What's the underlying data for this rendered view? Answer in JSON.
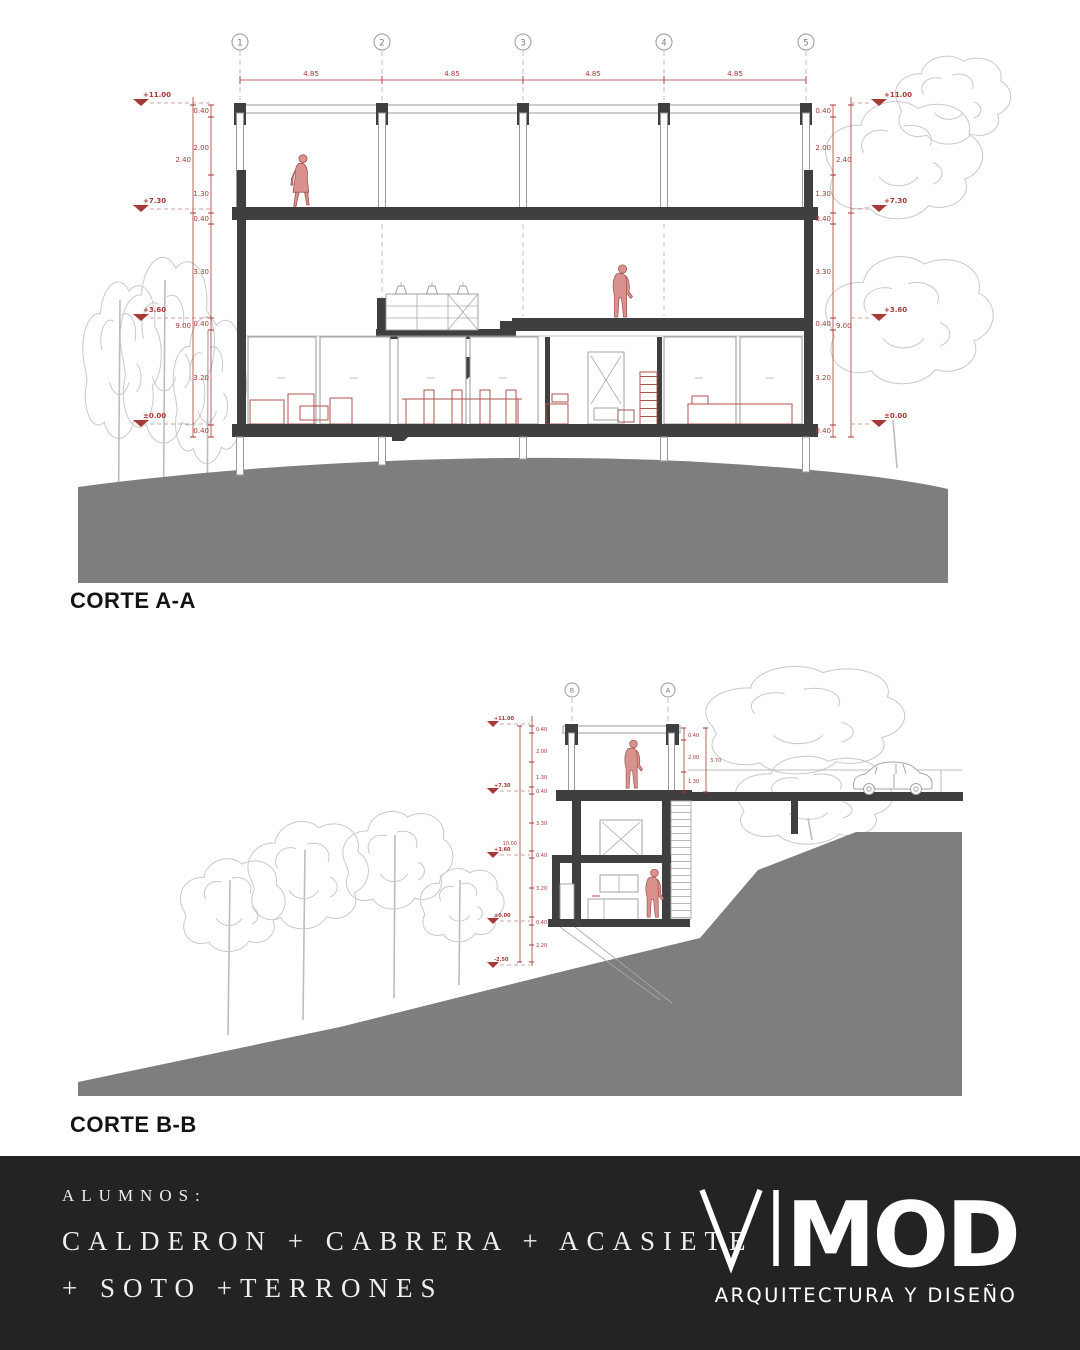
{
  "page": {
    "background": "#ffffff",
    "footer_bg": "#232323"
  },
  "colors": {
    "dimension_red": "#a63a36",
    "structure_dark": "#3f3f3f",
    "ground_gray": "#7e7e7e",
    "tree_gray": "#c9c9c9",
    "person_fill": "#d8918d",
    "person_stroke": "#9c4f4a",
    "furniture_red": "#b0524e",
    "footer_text": "#efefef"
  },
  "corte_a": {
    "label": "CORTE A-A",
    "grids": [
      "1",
      "2",
      "3",
      "4",
      "5"
    ],
    "spans": [
      "4.85",
      "4.85",
      "4.85",
      "4.85"
    ],
    "levels": [
      "+11.00",
      "+7.30",
      "+3.60",
      "±0.00"
    ],
    "dims_inner": [
      "0.40",
      "2.00",
      "1.30",
      "0.40",
      "3.30",
      "0.40",
      "3.20",
      "0.40"
    ],
    "dims_outer": [
      "2.40",
      "9.00"
    ]
  },
  "corte_b": {
    "label": "CORTE B-B",
    "grids": [
      "B",
      "A"
    ],
    "levels": [
      "+11.00",
      "+7.30",
      "+3.60",
      "±0.00",
      "-2.50"
    ],
    "dims_inner": [
      "0.40",
      "2.00",
      "1.30",
      "0.40",
      "3.30",
      "0.40",
      "3.20",
      "0.40",
      "2.20"
    ],
    "dims_outer": [
      "10.00"
    ],
    "dims_grid_a": [
      "0.40",
      "2.00",
      "1.30"
    ],
    "dims_grid_a_total": "3.70"
  },
  "footer": {
    "alumnos_label": "ALUMNOS:",
    "students_line_1": "CALDERON + CABRERA + ACASIETE",
    "students_line_2": "+ SOTO +TERRONES",
    "logo_vi": "VI",
    "logo_mod": "MOD",
    "logo_tagline": "ARQUITECTURA Y DISEÑO"
  }
}
